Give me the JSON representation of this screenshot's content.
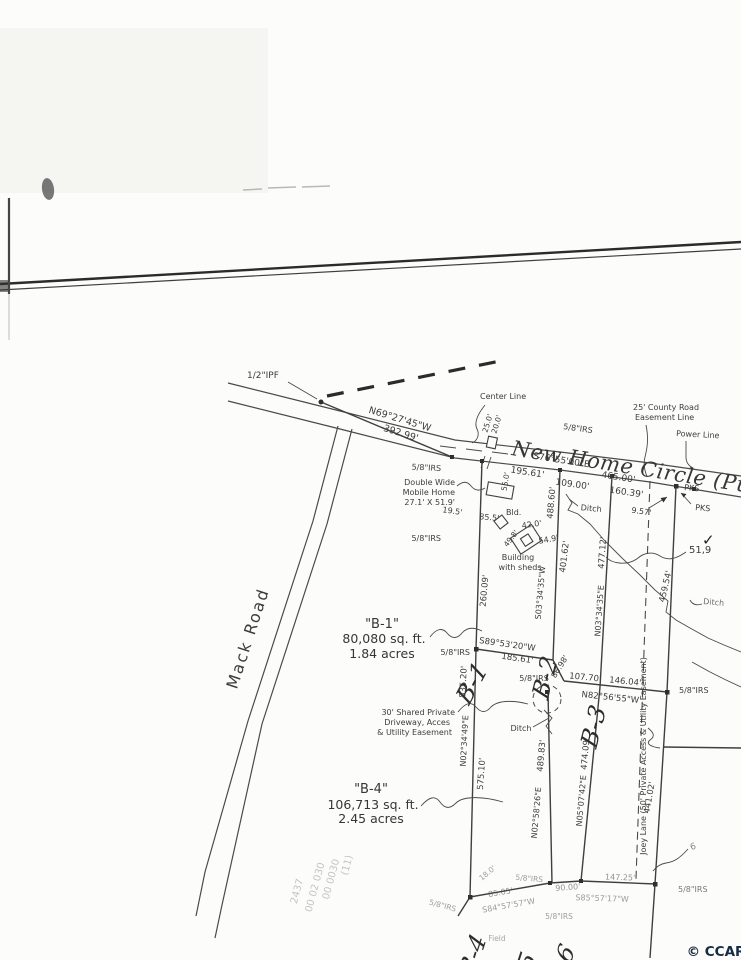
{
  "meta": {
    "copyright": "© CCAR"
  },
  "roads": {
    "mack": "Mack Road",
    "new_home": "New Home Circle (Pub",
    "joey": "Joey Lane (50' Private Access & Utility Easement)"
  },
  "labels": {
    "ipf": "1/2\"IPF",
    "center_line": "Center Line",
    "county1": "25' County Road",
    "county2": "Easement Line",
    "power": "Power Line",
    "irs": "5/8\"IRS",
    "pks": "PKS",
    "dw1": "Double Wide",
    "dw2": "Mobile Home",
    "dw3": "27.1' X 51.9'",
    "bld": "Bld.",
    "bws1": "Building",
    "bws2": "with sheds",
    "ditch": "Ditch",
    "drive1": "30' Shared Private",
    "drive2": "Driveway, Acces",
    "drive3": "& Utility Easement",
    "field": "Field",
    "note51": "51,9",
    "note6": "6",
    "check": "✓"
  },
  "bearings": {
    "n69": "N69°27'45\"W",
    "s76": "S76°55'00\"E",
    "s03": "S03°34'35\"W",
    "n03": "N03°34'35\"E",
    "s89": "S89°53'20\"W",
    "n82": "N82°56'55\"W",
    "n0234": "N02°34'49\"E",
    "n0258": "N02°58'26\"E",
    "n05": "N05°07'42\"E",
    "s84": "S84°57'57\"W",
    "s85": "S85°57'17\"W"
  },
  "dist": {
    "d392": "392.99'",
    "d195": "195.61'",
    "d465": "465.00'",
    "d109": "109.00'",
    "d160": "160.39'",
    "d25": "25.0'",
    "d20": "20.0'",
    "d55": "55.0'",
    "d19_5": "19.5'",
    "d85_5": "85.5'",
    "d42": "42.0'",
    "d49_8": "49.8'",
    "d54_9": "54.9'",
    "d488": "488.60'",
    "d401": "401.62'",
    "d477": "477.12'",
    "d459": "459.54'",
    "d260": "260.09'",
    "d185": "185.61'",
    "d9_57": "9.57'",
    "d86_98": "86.98'",
    "d107": "107.70'",
    "d146": "146.04'",
    "d835": "835.20'",
    "d575": "575.10'",
    "d489": "489.83'",
    "d474": "474.09'",
    "d441": "441.02'",
    "d18": "18.0'",
    "d85_05": "85.05'",
    "d90": "90.00'",
    "d147": "147.25'"
  },
  "lots": {
    "b1_title": "\"B-1\"",
    "b1_area": "80,080 sq. ft.",
    "b1_acres": "1.84 acres",
    "b4_title": "\"B-4\"",
    "b4_area": "106,713 sq. ft.",
    "b4_acres": "2.45 acres",
    "b1": "B-1",
    "b2": "B-2",
    "b3": "B-3",
    "b4": "B-4",
    "b5": "B-5",
    "b6": "B-6"
  },
  "faint": {
    "t1": "(11)",
    "t2": "00 0030",
    "t3": "00 02 030",
    "t4": "2437"
  }
}
